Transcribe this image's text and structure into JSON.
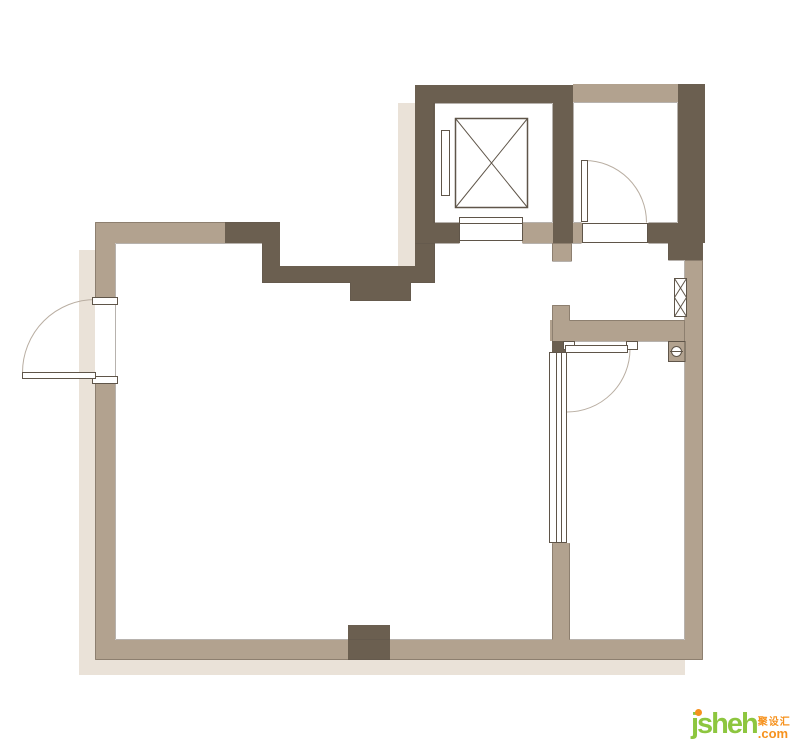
{
  "page": {
    "background": "#ffffff"
  },
  "palette": {
    "wall_dark": "#6b5f50",
    "wall_tan": "#b2a28f",
    "shadow": "#eae2d8",
    "line": "#5f5549",
    "fixture_fill": "#ffffff",
    "brand_color": "#8dc63f",
    "accent_color": "#f6921e"
  },
  "watermark": {
    "brand": "jsheh",
    "cn": "聚设汇",
    "com": ".com"
  },
  "plan": {
    "fixtures": [
      {
        "name": "elevator-shaft"
      },
      {
        "name": "elevator-cab"
      },
      {
        "name": "elevator-counterweight"
      },
      {
        "name": "elevator-door-sill"
      },
      {
        "name": "entry-swing-door"
      },
      {
        "name": "top-right-room-swing-door"
      },
      {
        "name": "right-room-swing-door"
      },
      {
        "name": "sliding-glass-panel"
      },
      {
        "name": "pipe-duct-symbol"
      },
      {
        "name": "floor-drain-symbol"
      }
    ]
  }
}
